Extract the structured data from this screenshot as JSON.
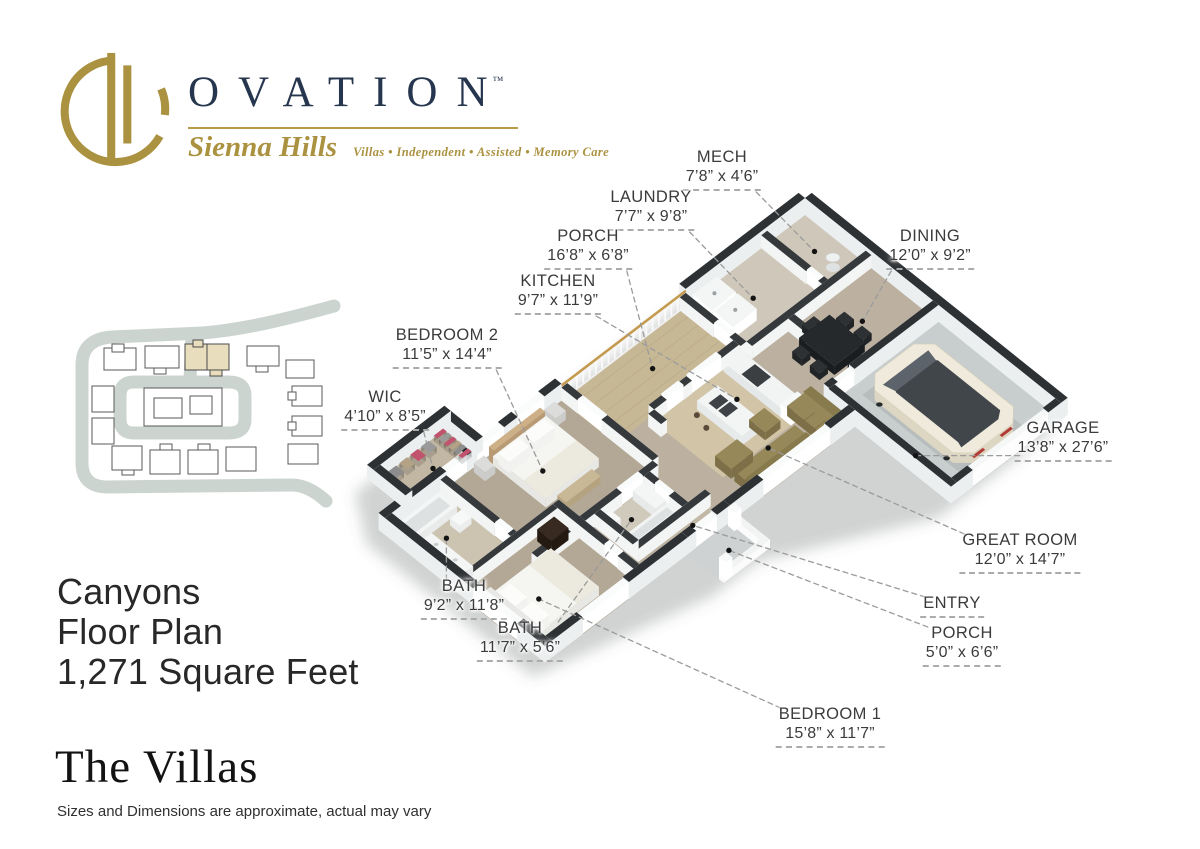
{
  "logo": {
    "brand": "OVATION",
    "trademark": "TM",
    "community": "Sienna Hills",
    "tagline": "Villas • Independent • Assisted • Memory Care"
  },
  "title_block": {
    "plan_name": "Canyons",
    "plan_type": "Floor Plan",
    "square_feet": "1,271 Square Feet"
  },
  "collection_name": "The Villas",
  "disclaimer": "Sizes and Dimensions are approximate, actual may vary",
  "floor_plan": {
    "rooms": [
      {
        "id": "mech",
        "name": "MECH",
        "dims": "7’8” x 4’6”"
      },
      {
        "id": "laundry",
        "name": "LAUNDRY",
        "dims": "7’7” x 9’8”"
      },
      {
        "id": "porch_nw",
        "name": "PORCH",
        "dims": "16’8” x 6’8”"
      },
      {
        "id": "kitchen",
        "name": "KITCHEN",
        "dims": "9’7” x 11’9”"
      },
      {
        "id": "bedroom2",
        "name": "BEDROOM 2",
        "dims": "11’5” x 14’4”"
      },
      {
        "id": "wic",
        "name": "WIC",
        "dims": "4’10” x 8’5”"
      },
      {
        "id": "dining",
        "name": "DINING",
        "dims": "12’0” x 9’2”"
      },
      {
        "id": "garage",
        "name": "GARAGE",
        "dims": "13’8” x 27’6”"
      },
      {
        "id": "great_room",
        "name": "GREAT ROOM",
        "dims": "12’0” x 14’7”"
      },
      {
        "id": "entry",
        "name": "ENTRY",
        "dims": ""
      },
      {
        "id": "porch_se",
        "name": "PORCH",
        "dims": "5’0” x 6’6”"
      },
      {
        "id": "bath_master",
        "name": "BATH",
        "dims": "9’2” x 11’8”"
      },
      {
        "id": "bath_hall",
        "name": "BATH",
        "dims": "11’7” x 5’6”"
      },
      {
        "id": "bedroom1",
        "name": "BEDROOM 1",
        "dims": "15’8” x 11’7”"
      }
    ]
  },
  "colors": {
    "gold": "#ab9240",
    "navy": "#26364e",
    "label_text": "#3b3b3b",
    "wall_top": "#2d3134",
    "floor_tan": "#bcb1a0",
    "garage_concrete": "#c8cdcd",
    "sofa_olive": "#968858",
    "road_gray": "#ccd4d0",
    "lot_highlight": "#e8debd"
  }
}
